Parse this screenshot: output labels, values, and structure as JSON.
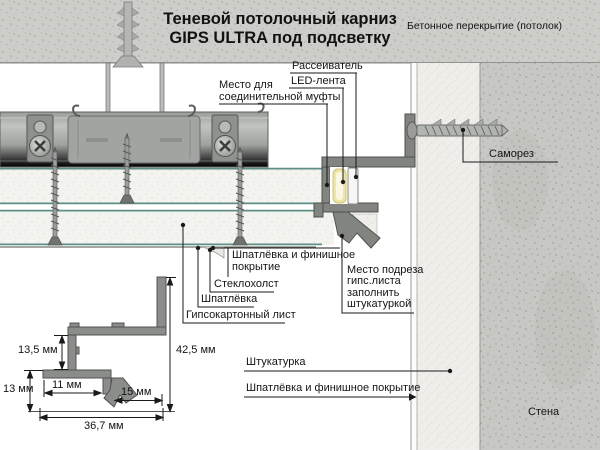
{
  "title": {
    "line1": "Теневой потолочный карниз",
    "line2": "GIPS ULTRA под подсветку"
  },
  "labels": {
    "ceiling_slab": "Бетонное перекрытие (потолок)",
    "diffuser": "Рассеиватель",
    "led_strip": "LED-лента",
    "coupling_line1": "Место для",
    "coupling_line2": "соединительной муфты",
    "screw": "Саморез",
    "finish_top_line1": "Шпатлёвка и финишное",
    "finish_top_line2": "покрытие",
    "fiberglass": "Стеклохолст",
    "putty": "Шпатлёвка",
    "drywall": "Гипсокартонный лист",
    "cut_line1": "Место подреза",
    "cut_line2": "гипс.листа",
    "cut_line3": "заполнить",
    "cut_line4": "штукатуркой",
    "plaster": "Штукатурка",
    "finish_bottom": "Шпатлёвка и финишное покрытие",
    "wall": "Стена"
  },
  "dimensions": {
    "d13_5": "13,5 мм",
    "d42_5": "42,5 мм",
    "d11": "11 мм",
    "d13": "13 мм",
    "d15": "15 мм",
    "d36_7": "36,7 мм"
  },
  "colors": {
    "concrete": "#cdcdc9",
    "wall_concrete": "#c7c7c4",
    "stucco": "#f0eeea",
    "drywall_core": "#f3f3f0",
    "green_edge": "#5e8f85",
    "metal_profile": "#8b8d8a",
    "led_yellow": "#efe6a6",
    "text": "#141414"
  }
}
